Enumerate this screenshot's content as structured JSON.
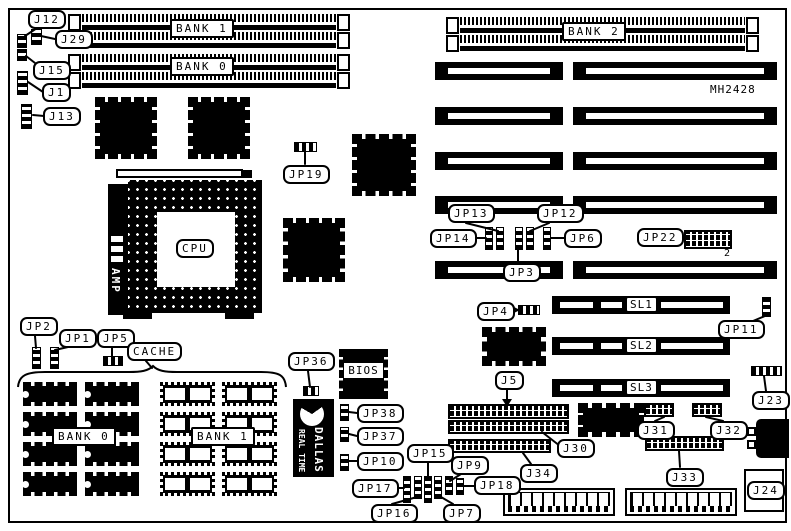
{
  "board": {
    "part_number": "MH2428"
  },
  "memory": {
    "simm_bank1_label": "BANK 1",
    "simm_bank0_label": "BANK 0",
    "simm_bank2_label": "BANK 2",
    "cache_label": "CACHE",
    "cache_bank0_label": "BANK 0",
    "cache_bank1_label": "BANK 1"
  },
  "cpu": {
    "socket_label": "CPU",
    "regulator_label": "AMP"
  },
  "chips": {
    "bios_label": "BIOS",
    "rtc_brand": "DALLAS",
    "rtc_type": "REAL TIME"
  },
  "slots": {
    "sl1": "SL1",
    "sl2": "SL2",
    "sl3": "SL3"
  },
  "jumpers": {
    "j12": "J12",
    "j29": "J29",
    "j15": "J15",
    "j1": "J1",
    "j13": "J13",
    "jp19": "JP19",
    "jp13": "JP13",
    "jp12": "JP12",
    "jp14": "JP14",
    "jp6": "JP6",
    "jp3": "JP3",
    "jp22": "JP22",
    "jp22_pin2": "2",
    "jp4": "JP4",
    "jp11": "JP11",
    "j23": "J23",
    "jp2": "JP2",
    "jp1": "JP1",
    "jp5": "JP5",
    "jp36": "JP36",
    "jp38": "JP38",
    "jp37": "JP37",
    "jp10": "JP10",
    "jp17": "JP17",
    "jp16": "JP16",
    "jp15": "JP15",
    "jp7": "JP7",
    "jp9": "JP9",
    "jp18": "JP18",
    "j5": "J5",
    "j30": "J30",
    "j34": "J34",
    "j31": "J31",
    "j32": "J32",
    "j33": "J33",
    "j24": "J24"
  }
}
